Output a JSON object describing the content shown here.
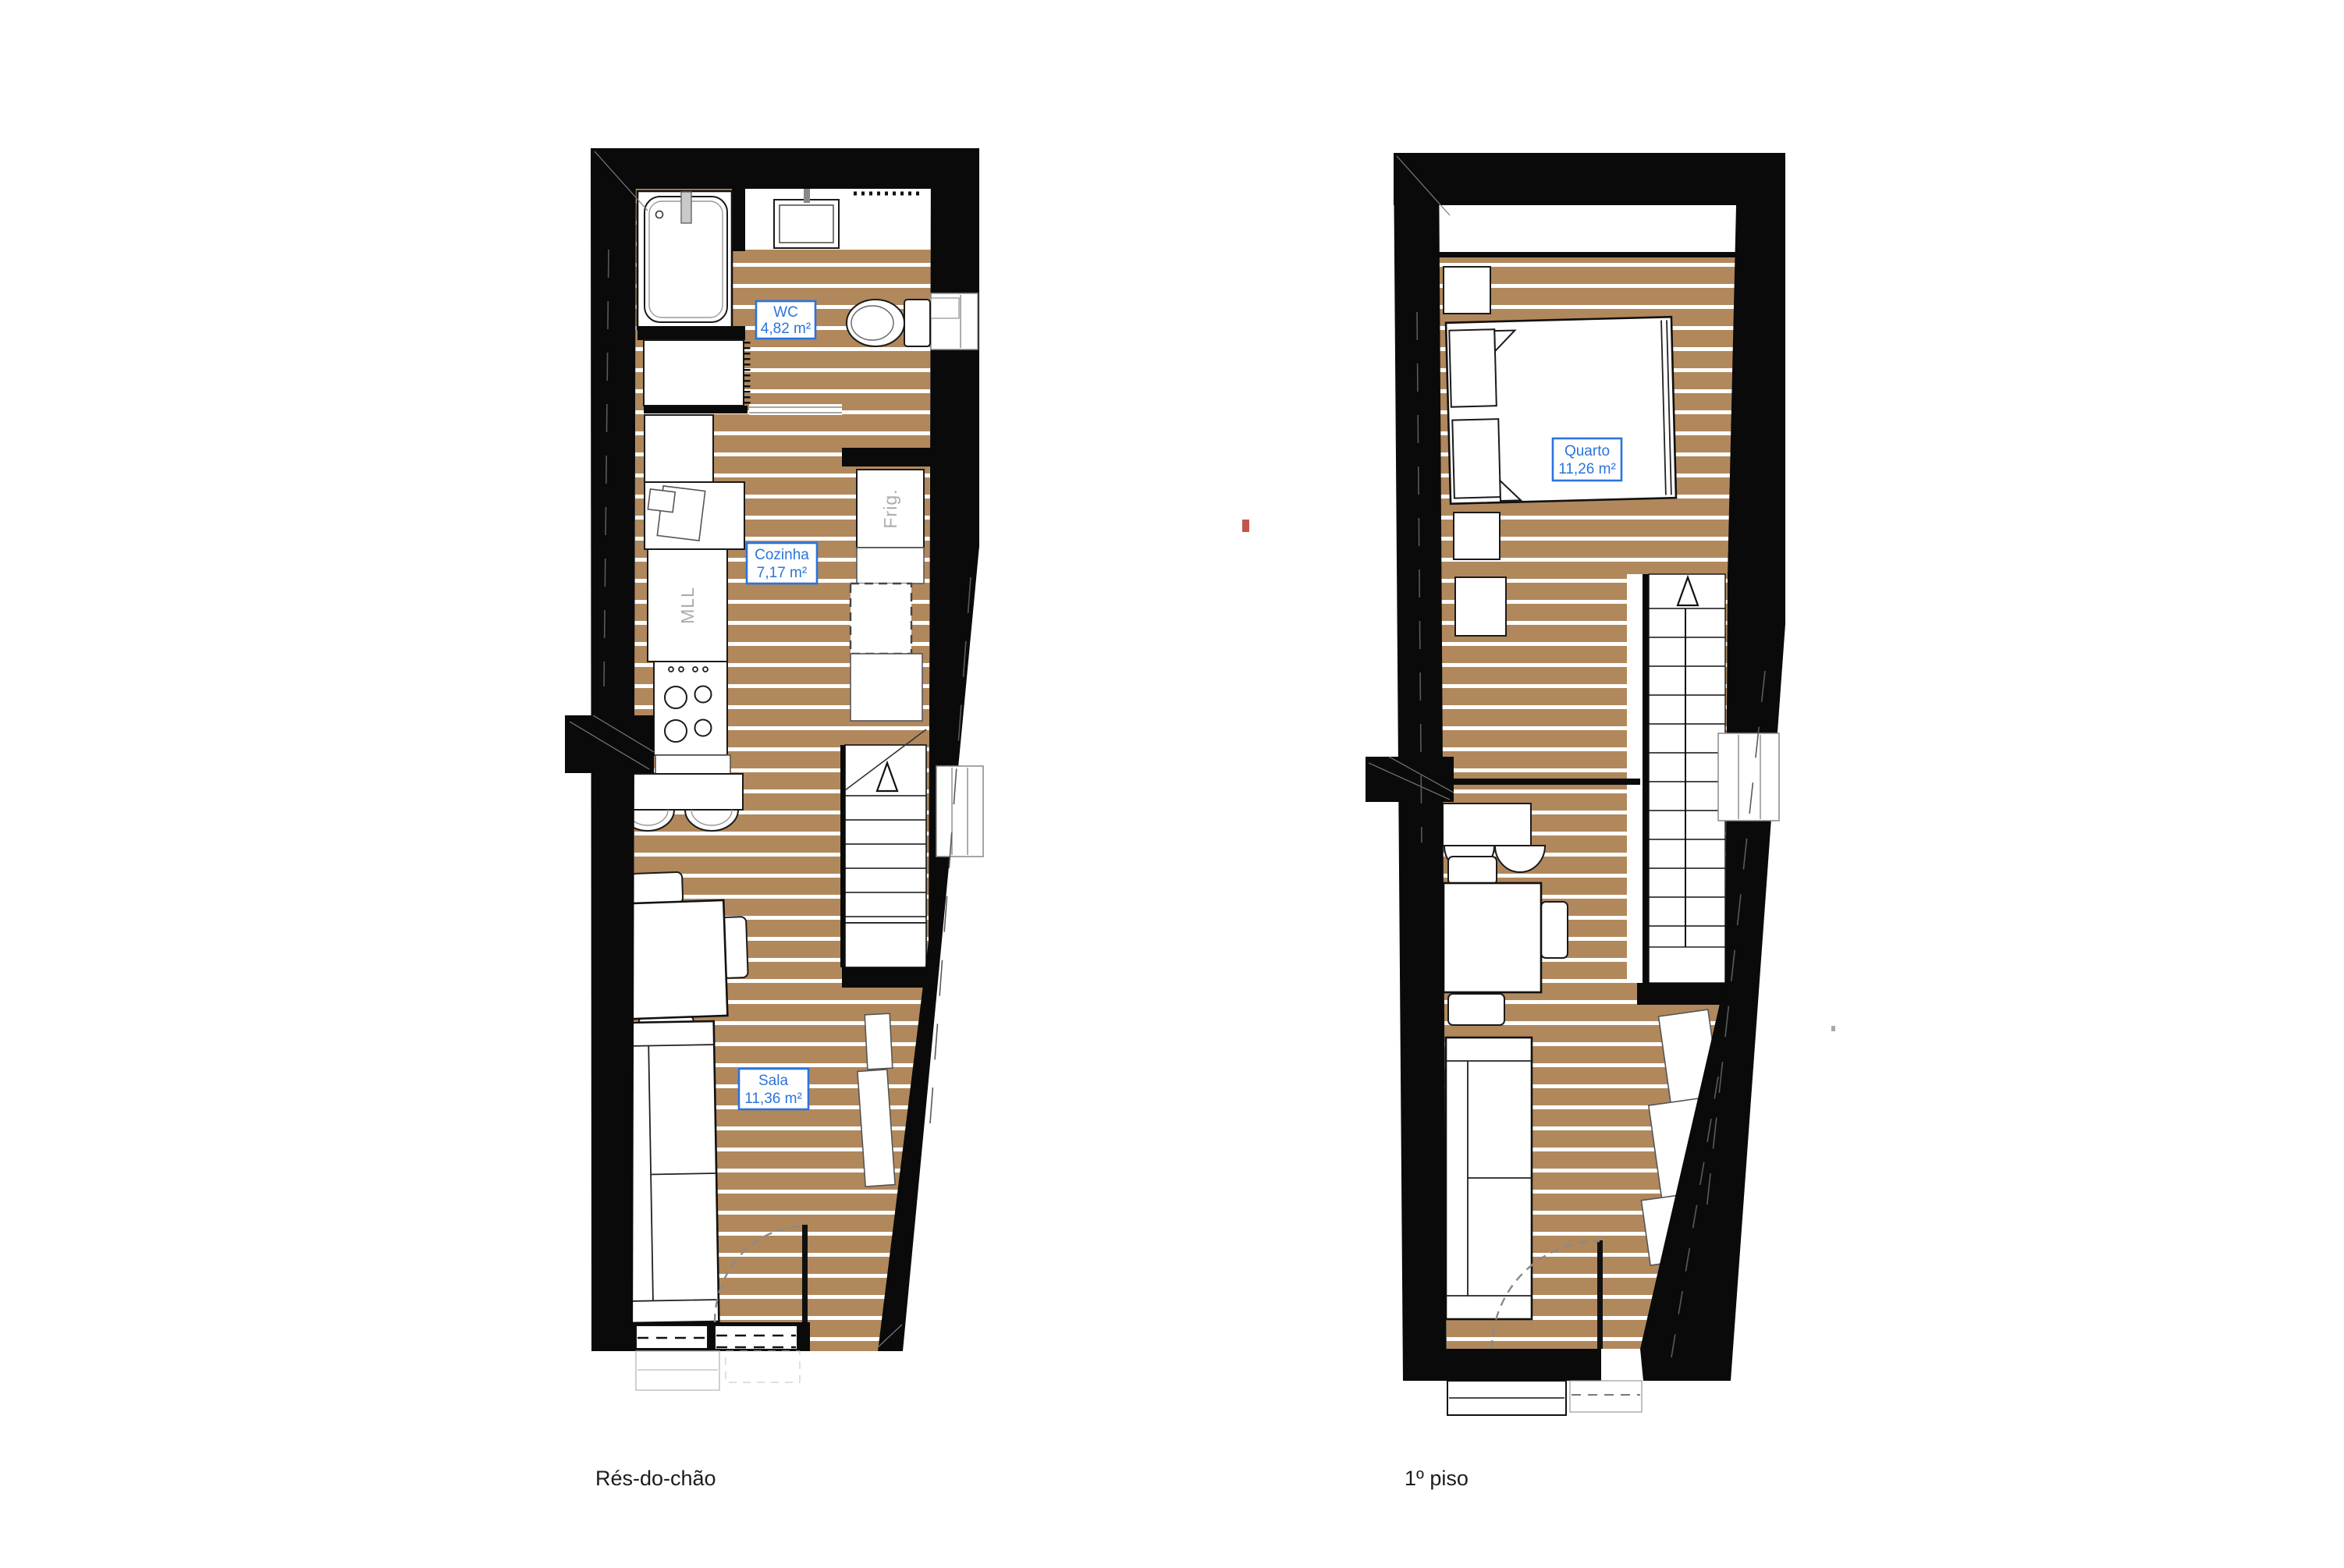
{
  "page": {
    "background": "#ffffff"
  },
  "captions": {
    "ground_floor": "Rés-do-chão",
    "first_floor": "1º piso"
  },
  "rooms": {
    "wc": {
      "name": "WC",
      "area": "4,82 m²"
    },
    "cozinha": {
      "name": "Cozinha",
      "area": "7,17 m²"
    },
    "sala": {
      "name": "Sala",
      "area": "11,36 m²"
    },
    "quarto": {
      "name": "Quarto",
      "area": "11,26 m²"
    }
  },
  "appliances": {
    "fridge_label": "Frig.",
    "washer_label": "MLL"
  },
  "colors": {
    "floor_wood": "#b1885c",
    "floor_stripe": "#ffffff",
    "wall": "#0a0a0a",
    "label_blue": "#2b74db",
    "appliance_gray": "#ababab",
    "caption_text": "#1c1c1c",
    "red_mark": "#c4554d"
  }
}
